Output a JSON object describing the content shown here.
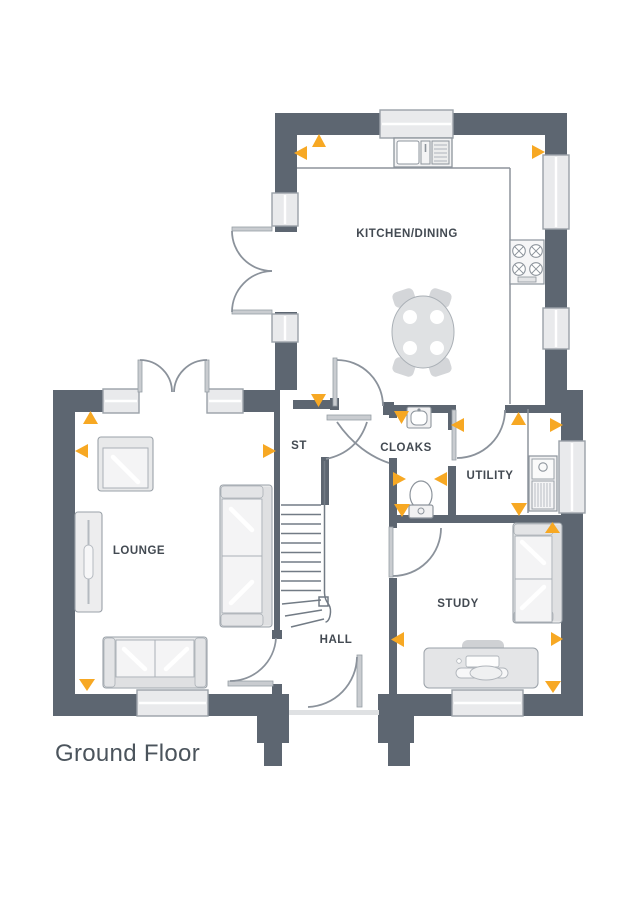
{
  "title": "Ground Floor",
  "rooms": {
    "kitchen": "KITCHEN/DINING",
    "lounge": "LOUNGE",
    "hall": "HALL",
    "study": "STUDY",
    "cloaks": "CLOAKS",
    "utility": "UTILITY",
    "store": "ST"
  },
  "colors": {
    "wall": "#5d6671",
    "marker_accent": "#f7a823",
    "furniture_fill": "#f1f1f2",
    "outline": "#9aa1a8",
    "window_fill": "#e9eaec",
    "label_text": "#434a52"
  },
  "markers": {
    "shape": "triangle",
    "color": "#f7a823",
    "count": 20
  },
  "fixtures": [
    "dining-table",
    "kitchen-sink",
    "hob",
    "washing-machine",
    "basin",
    "toilet",
    "stairs",
    "sofa",
    "armchair",
    "radiator",
    "desk",
    "french-doors",
    "windows"
  ]
}
